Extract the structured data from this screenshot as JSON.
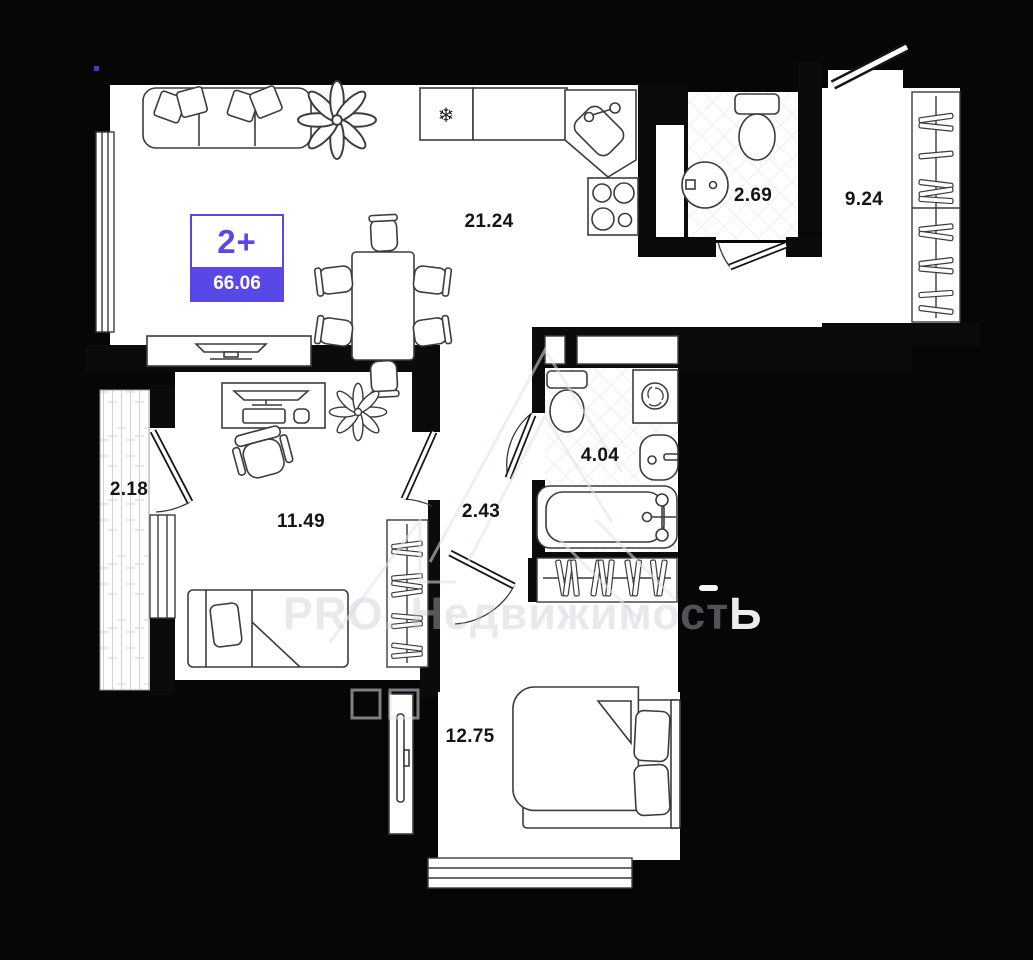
{
  "badge": {
    "rooms_label": "2+",
    "total_area": "66.06"
  },
  "rooms": [
    {
      "name": "living-kitchen",
      "area": "21.24"
    },
    {
      "name": "bathroom-small",
      "area": "2.69"
    },
    {
      "name": "entrance-hall",
      "area": "9.24"
    },
    {
      "name": "balcony",
      "area": "2.18"
    },
    {
      "name": "bedroom-left",
      "area": "11.49"
    },
    {
      "name": "hallway",
      "area": "2.43"
    },
    {
      "name": "bathroom-main",
      "area": "4.04"
    },
    {
      "name": "bedroom-bottom",
      "area": "12.75"
    }
  ],
  "watermark": {
    "brand": "PRO. Недвижимост",
    "brand_last": "Ь"
  },
  "icons": {
    "fridge": "❄"
  },
  "colors": {
    "accent": "#5a47e7",
    "walls": "#0b0b0b",
    "floor": "#ffffff"
  }
}
